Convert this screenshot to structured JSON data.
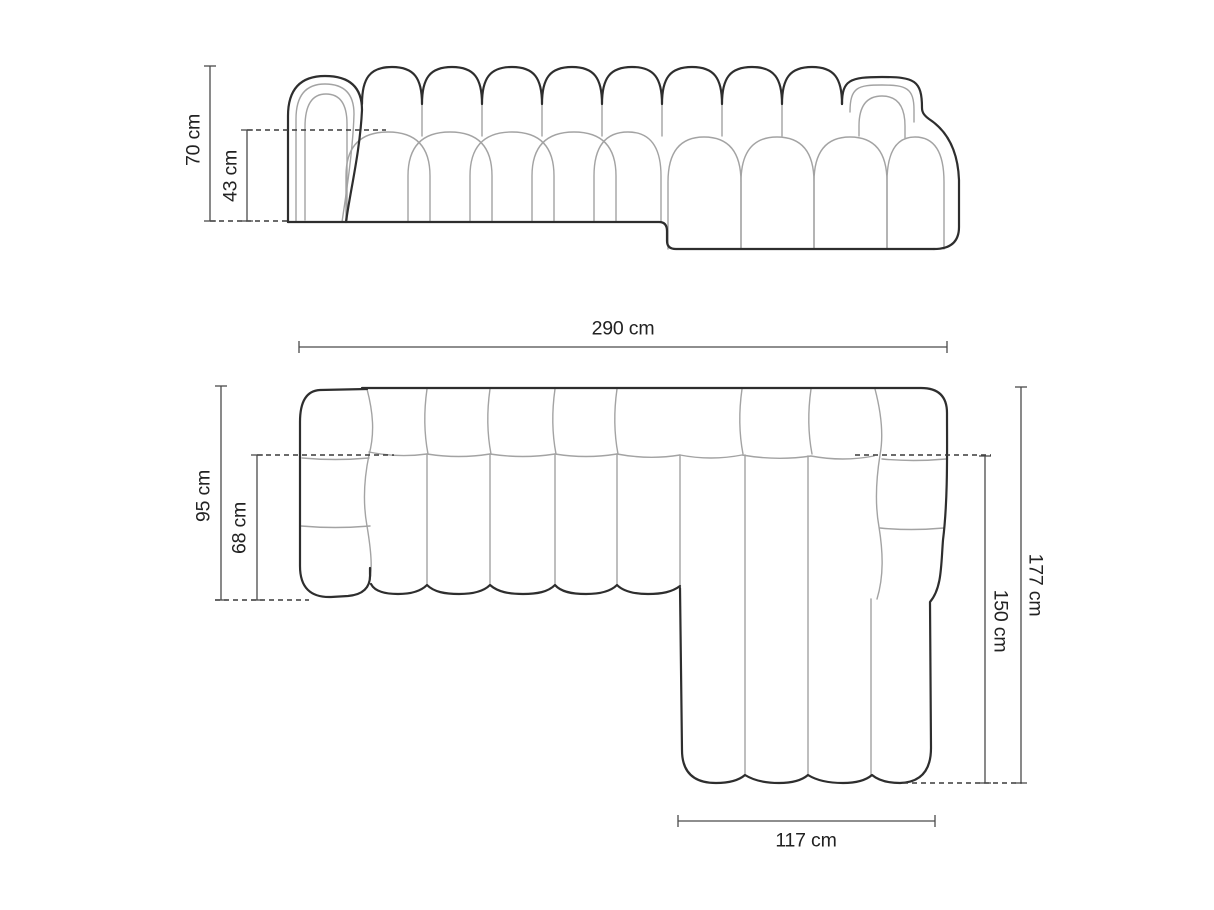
{
  "diagram": {
    "dimensions": {
      "front_height_total": "70 cm",
      "front_seat_height": "43 cm",
      "top_width_total": "290 cm",
      "top_depth_total": "95 cm",
      "top_seat_depth": "68 cm",
      "top_length_total": "177 cm",
      "top_chaise_length": "150 cm",
      "top_chaise_width": "117 cm"
    },
    "colors": {
      "background": "#ffffff",
      "outline_dark": "#2e2e2e",
      "outline_light": "#a3a3a3",
      "dimension_line": "#4a4a4a",
      "label_text": "#222222"
    }
  }
}
